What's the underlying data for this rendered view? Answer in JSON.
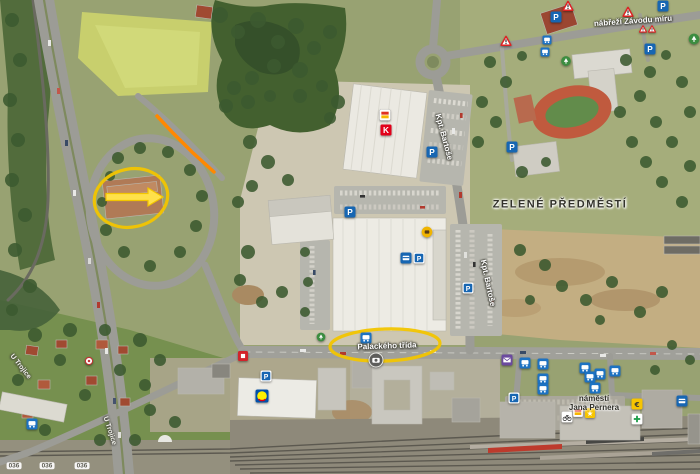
{
  "map": {
    "labels": [
      {
        "name": "street-label-nabrezi-zavodu-miru",
        "text": "nábřeží Závodu míru",
        "x": 633,
        "y": 21,
        "rot": -4,
        "cls": "street"
      },
      {
        "name": "district-label-zelene-predmesti",
        "text": "ZELENÉ PŘEDMĚSTÍ",
        "x": 560,
        "y": 205,
        "rot": 0,
        "cls": "district"
      },
      {
        "name": "street-label-kpt-bartose-north",
        "text": "Kpt. Bartoše",
        "x": 444,
        "y": 137,
        "rot": 75,
        "cls": "street"
      },
      {
        "name": "street-label-kpt-bartose-south",
        "text": "Kpt. Bartoše",
        "x": 488,
        "y": 283,
        "rot": 78,
        "cls": "street"
      },
      {
        "name": "street-label-palackeho-trida",
        "text": "Palackého třída",
        "x": 387,
        "y": 346,
        "rot": -2,
        "cls": "street"
      },
      {
        "name": "place-label-namesti-jana-pernera",
        "text": "náměstí\nJana Pernera",
        "x": 594,
        "y": 403,
        "rot": 0,
        "cls": "place"
      },
      {
        "name": "street-label-u-trojice-west",
        "text": "U Trojice",
        "x": 20,
        "y": 367,
        "rot": 52,
        "cls": "street-sm"
      },
      {
        "name": "street-label-u-trojice-east",
        "text": "U Trojice",
        "x": 109,
        "y": 431,
        "rot": 72,
        "cls": "street-sm"
      },
      {
        "name": "route-marker",
        "text": "036",
        "x": 14,
        "y": 466,
        "rot": 0,
        "cls": "route"
      },
      {
        "name": "route-marker",
        "text": "036",
        "x": 47,
        "y": 466,
        "rot": 0,
        "cls": "route"
      },
      {
        "name": "route-marker",
        "text": "036",
        "x": 82,
        "y": 466,
        "rot": 0,
        "cls": "route"
      }
    ],
    "icons": [
      {
        "name": "warning-icon",
        "type": "warning",
        "x": 568,
        "y": 6
      },
      {
        "name": "parking-icon",
        "type": "parking",
        "x": 556,
        "y": 17
      },
      {
        "name": "warning-icon",
        "type": "warning",
        "x": 628,
        "y": 12
      },
      {
        "name": "parking-icon",
        "type": "parking",
        "x": 663,
        "y": 6
      },
      {
        "name": "bus-stop-icon",
        "type": "bus",
        "x": 547,
        "y": 40,
        "s": 9
      },
      {
        "name": "bus-stop-icon",
        "type": "bus",
        "x": 545,
        "y": 52,
        "s": 9
      },
      {
        "name": "warning-icon",
        "type": "warning",
        "x": 506,
        "y": 41
      },
      {
        "name": "warning-icon",
        "type": "warning",
        "x": 643,
        "y": 29,
        "s": 8
      },
      {
        "name": "warning-icon",
        "type": "warning",
        "x": 652,
        "y": 29,
        "s": 8
      },
      {
        "name": "parking-icon",
        "type": "parking",
        "x": 650,
        "y": 49
      },
      {
        "name": "tree-icon",
        "type": "tree",
        "x": 694,
        "y": 39
      },
      {
        "name": "tree-icon",
        "type": "tree",
        "x": 566,
        "y": 61,
        "s": 10
      },
      {
        "name": "parking-icon",
        "type": "parking",
        "x": 512,
        "y": 147
      },
      {
        "name": "shop-icon",
        "type": "shop",
        "x": 385,
        "y": 115
      },
      {
        "name": "kaufland-logo-icon",
        "type": "kaufland",
        "x": 386,
        "y": 130
      },
      {
        "name": "parking-icon",
        "type": "parking",
        "x": 432,
        "y": 152
      },
      {
        "name": "parking-icon",
        "type": "parking",
        "x": 350,
        "y": 212
      },
      {
        "name": "cafe-icon",
        "type": "cafe",
        "x": 427,
        "y": 232
      },
      {
        "name": "atm-icon",
        "type": "atm",
        "x": 406,
        "y": 258
      },
      {
        "name": "parking-lot-icon",
        "type": "parking-boxed",
        "x": 419,
        "y": 258
      },
      {
        "name": "parking-lot-icon",
        "type": "parking-boxed",
        "x": 468,
        "y": 288
      },
      {
        "name": "tree-icon",
        "type": "tree",
        "x": 321,
        "y": 337,
        "s": 9
      },
      {
        "name": "bus-stop-icon",
        "type": "bus",
        "x": 366,
        "y": 338
      },
      {
        "name": "photo-poi-icon",
        "type": "photo",
        "x": 376,
        "y": 360,
        "s": 15
      },
      {
        "name": "poi-icon",
        "type": "redpoi",
        "x": 243,
        "y": 356,
        "s": 10
      },
      {
        "name": "parking-lot-icon",
        "type": "parking-boxed",
        "x": 266,
        "y": 376
      },
      {
        "name": "lidl-logo-icon",
        "type": "lidl",
        "x": 262,
        "y": 396,
        "s": 13
      },
      {
        "name": "monument-icon",
        "type": "monument",
        "x": 89,
        "y": 361,
        "s": 9
      },
      {
        "name": "bus-stop-icon",
        "type": "bus",
        "x": 32,
        "y": 424
      },
      {
        "name": "post-office-icon",
        "type": "post",
        "x": 507,
        "y": 360
      },
      {
        "name": "bus-stop-icon",
        "type": "bus",
        "x": 525,
        "y": 363
      },
      {
        "name": "bus-stop-icon",
        "type": "bus",
        "x": 543,
        "y": 364
      },
      {
        "name": "bus-stop-icon",
        "type": "bus",
        "x": 585,
        "y": 368
      },
      {
        "name": "bus-stop-icon",
        "type": "bus",
        "x": 615,
        "y": 371
      },
      {
        "name": "bus-stop-icon",
        "type": "bus",
        "x": 600,
        "y": 374
      },
      {
        "name": "bus-stop-icon",
        "type": "bus",
        "x": 590,
        "y": 377
      },
      {
        "name": "bus-stop-icon",
        "type": "bus",
        "x": 543,
        "y": 379
      },
      {
        "name": "bus-stop-icon",
        "type": "bus",
        "x": 543,
        "y": 389
      },
      {
        "name": "bus-stop-icon",
        "type": "bus",
        "x": 595,
        "y": 388
      },
      {
        "name": "parking-lot-icon",
        "type": "parking-boxed",
        "x": 514,
        "y": 398
      },
      {
        "name": "bicycle-icon",
        "type": "bicycle",
        "x": 567,
        "y": 417
      },
      {
        "name": "shop-icon",
        "type": "shop",
        "x": 578,
        "y": 412,
        "s": 10
      },
      {
        "name": "star-icon",
        "type": "star",
        "x": 590,
        "y": 413,
        "s": 10
      },
      {
        "name": "exchange-icon",
        "type": "exchange",
        "x": 637,
        "y": 404
      },
      {
        "name": "pharmacy-icon",
        "type": "pharmacy",
        "x": 637,
        "y": 419
      },
      {
        "name": "atm-icon",
        "type": "atm",
        "x": 682,
        "y": 401
      }
    ],
    "annotations": {
      "color": "#f2c500",
      "arrow_fill": "#ffe14a",
      "route_color": "#ff8800",
      "ellipses": [
        {
          "cx": 131,
          "cy": 198,
          "rx": 37,
          "ry": 29,
          "rot": -12
        },
        {
          "cx": 385,
          "cy": 345,
          "rx": 55,
          "ry": 16,
          "rot": -2
        }
      ],
      "arrow": {
        "x1": 106,
        "y1": 197,
        "x2": 163,
        "y2": 196
      },
      "route_line": {
        "points": "157,116 172,132 192,152 214,172"
      }
    }
  }
}
